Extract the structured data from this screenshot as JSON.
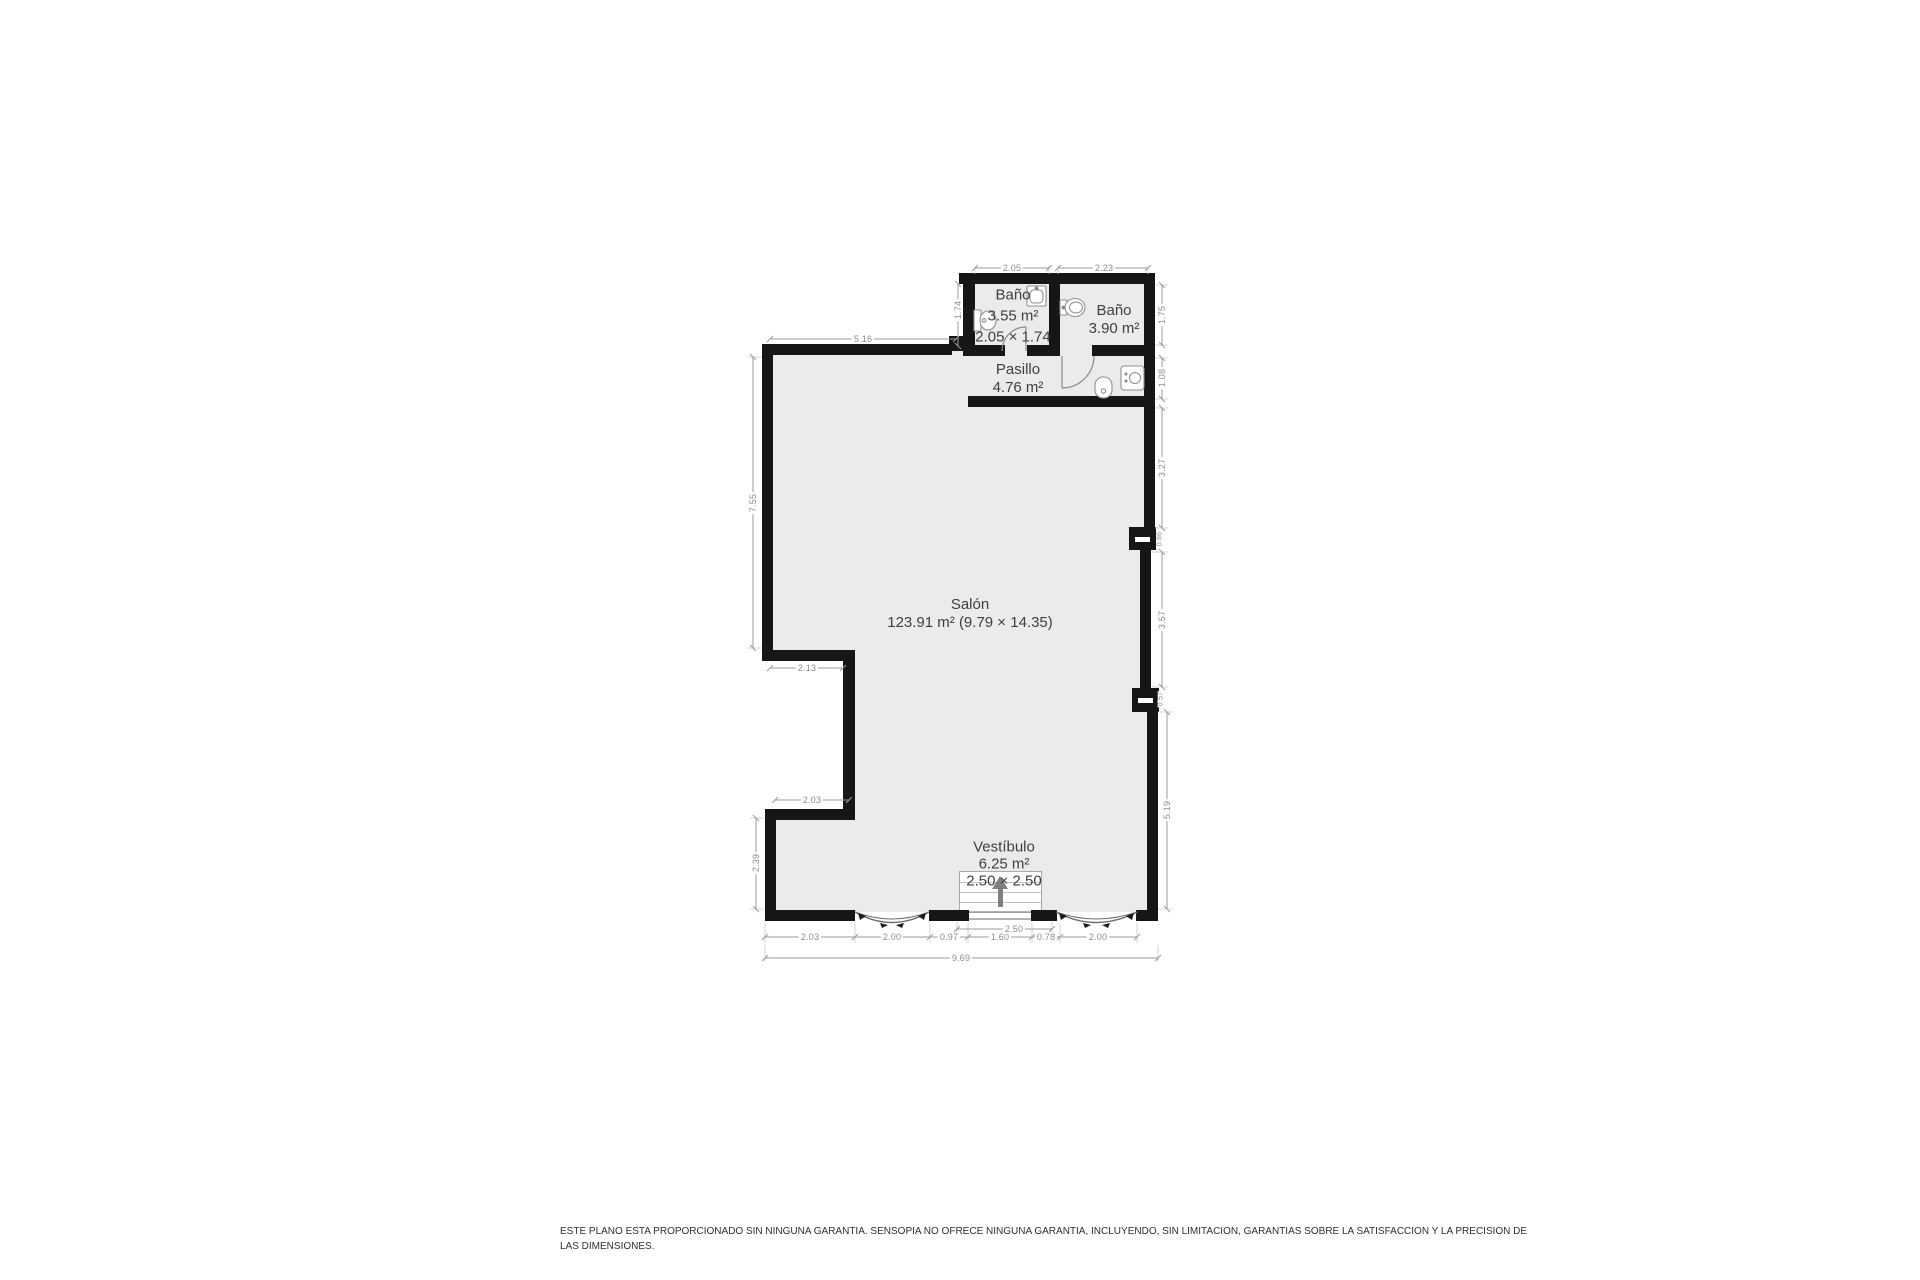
{
  "floorplan": {
    "rooms": {
      "salon": {
        "name": "Salón",
        "area": "123.91 m² (9.79 × 14.35)"
      },
      "bano_left": {
        "name": "Baño",
        "area": "3.55 m²",
        "size": "2.05 × 1.74"
      },
      "bano_right": {
        "name": "Baño",
        "area": "3.90 m²"
      },
      "pasillo": {
        "name": "Pasillo",
        "area": "4.76 m²"
      },
      "vestibulo": {
        "name": "Vestíbulo",
        "area": "6.25 m²",
        "size": "2.50 × 2.50"
      }
    },
    "dimensions": {
      "bano_left_width": "2.05",
      "bano_right_width": "2.23",
      "top_wall_length": "5.16",
      "bano_left_height": "1.74",
      "bano_right_height": "1.75",
      "pasillo_right_height": "1.08",
      "right_upper": "3.27",
      "right_middle": "3.57",
      "right_lower": "5.19",
      "pillar_upper": "0.86",
      "pillar_lower": "0.57",
      "left_upper": "7.55",
      "left_lower": "2.39",
      "notch_top": "2.13",
      "notch_bottom": "2.03",
      "bottom_seg_1": "2.03",
      "bottom_seg_2": "2.00",
      "bottom_seg_3": "0.97",
      "bottom_seg_4": "1.60",
      "bottom_seg_5": "0.78",
      "bottom_seg_6": "2.00",
      "vestibulo_width": "2.50",
      "bottom_total": "9.69"
    },
    "colors": {
      "wall": "#161616",
      "floor": "#ebebeb",
      "dimension": "#8c8c8c",
      "label": "#3f3f3f"
    }
  },
  "footer": {
    "disclaimer_line1": "ESTE PLANO ESTA PROPORCIONADO SIN NINGUNA GARANTIA. SENSOPIA NO OFRECE NINGUNA GARANTIA, INCLUYENDO, SIN LIMITACION, GARANTIAS SOBRE LA SATISFACCION Y LA PRECISION DE",
    "disclaimer_line2": "LAS DIMENSIONES."
  }
}
